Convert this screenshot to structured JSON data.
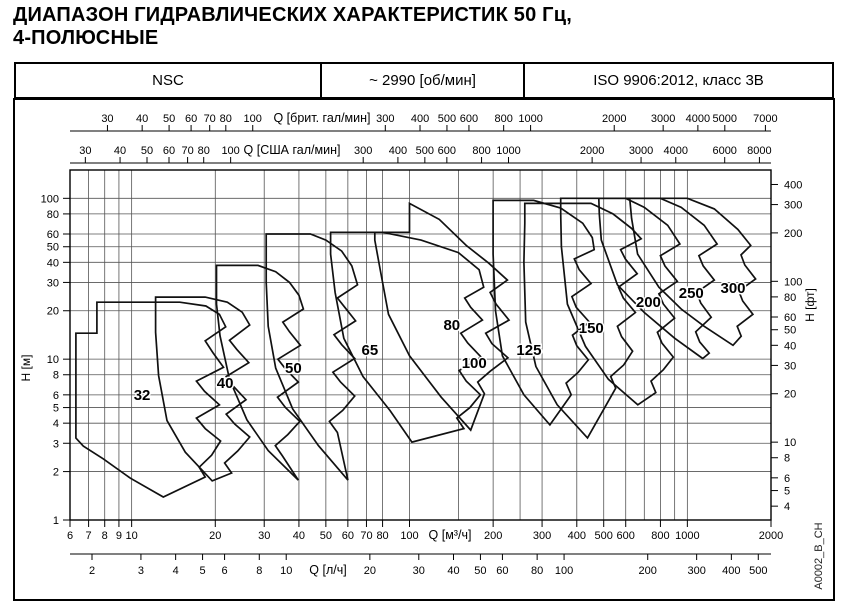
{
  "title": {
    "line1": "ДИАПАЗОН ГИДРАВЛИЧЕСКИХ ХАРАКТЕРИСТИК 50 Гц,",
    "line2": "4-ПОЛЮСНЫЕ"
  },
  "header": {
    "series": "NSC",
    "speed": "~ 2990 [об/мин]",
    "standard": "ISO 9906:2012, класс 3В"
  },
  "watermark": "A0002_B_CH",
  "colors": {
    "envelope_line": "#111111",
    "grid": "#555555",
    "border": "#000000",
    "background": "#ffffff"
  },
  "chart_data": {
    "type": "area",
    "subtype": "log-log pump range envelopes",
    "axes": {
      "x_main": {
        "label": "Q [м³/ч]",
        "scale": "log",
        "range": [
          6,
          2000
        ],
        "ticks": [
          6,
          7,
          8,
          9,
          10,
          20,
          30,
          40,
          50,
          60,
          70,
          80,
          100,
          200,
          300,
          400,
          500,
          600,
          800,
          1000,
          2000
        ],
        "gridlines": [
          6,
          7,
          8,
          9,
          10,
          20,
          30,
          40,
          50,
          60,
          70,
          80,
          100,
          150,
          200,
          250,
          300,
          400,
          500,
          600,
          700,
          800,
          900,
          1000,
          2000
        ]
      },
      "x_imp_gpm": {
        "label": "Q [брит. гал/мин]",
        "to_m3h": 0.27277,
        "ticks": [
          30,
          40,
          50,
          60,
          70,
          80,
          100,
          300,
          400,
          500,
          600,
          800,
          1000,
          2000,
          3000,
          4000,
          5000,
          7000
        ]
      },
      "x_us_gpm": {
        "label": "Q [США гал/мин]",
        "to_m3h": 0.22712,
        "ticks": [
          30,
          40,
          50,
          60,
          70,
          80,
          100,
          300,
          400,
          500,
          600,
          800,
          1000,
          2000,
          3000,
          4000,
          6000,
          8000
        ]
      },
      "x_ls": {
        "label": "Q [л/ч]",
        "to_m3h": 3.6,
        "ticks": [
          2,
          3,
          4,
          5,
          6,
          8,
          10,
          20,
          30,
          40,
          50,
          60,
          80,
          100,
          200,
          300,
          400,
          500
        ]
      },
      "y_main": {
        "label": "H [м]",
        "scale": "log",
        "range": [
          1,
          150
        ],
        "ticks": [
          1,
          2,
          3,
          4,
          5,
          6,
          8,
          10,
          20,
          30,
          40,
          50,
          60,
          80,
          100
        ],
        "gridlines": [
          1,
          2,
          3,
          4,
          5,
          6,
          8,
          10,
          20,
          30,
          40,
          50,
          60,
          80,
          100
        ]
      },
      "y_ft": {
        "label": "H [фт]",
        "to_m": 0.3048,
        "ticks": [
          4,
          5,
          6,
          8,
          10,
          20,
          30,
          40,
          50,
          60,
          80,
          100,
          200,
          300,
          400
        ]
      }
    },
    "envelopes": [
      {
        "label": "32",
        "label_at": [
          10.9,
          6.0
        ],
        "points": [
          [
            6.3,
            14.5
          ],
          [
            7.5,
            14.5
          ],
          [
            7.5,
            22.6
          ],
          [
            14.9,
            22.6
          ],
          [
            18.5,
            21.4
          ],
          [
            20.7,
            19
          ],
          [
            21.8,
            15.9
          ],
          [
            18.4,
            13
          ],
          [
            19.6,
            11
          ],
          [
            21.4,
            8.9
          ],
          [
            17.1,
            7.3
          ],
          [
            18.3,
            6.3
          ],
          [
            20.7,
            5.2
          ],
          [
            17.1,
            4.3
          ],
          [
            18.4,
            3.7
          ],
          [
            20.9,
            3.1
          ],
          [
            19.4,
            2.53
          ],
          [
            17.5,
            2.13
          ],
          [
            18.4,
            1.85
          ],
          [
            13,
            1.39
          ],
          [
            9.9,
            1.82
          ],
          [
            7.9,
            2.4
          ],
          [
            6.7,
            2.88
          ],
          [
            6.3,
            3.23
          ]
        ]
      },
      {
        "label": "40",
        "label_at": [
          21.7,
          7.1
        ],
        "points": [
          [
            12.2,
            24.3
          ],
          [
            18.4,
            24.3
          ],
          [
            22.1,
            22.6
          ],
          [
            25,
            19.6
          ],
          [
            26.6,
            16.3
          ],
          [
            22.5,
            13.1
          ],
          [
            23.9,
            11.5
          ],
          [
            26.4,
            9.5
          ],
          [
            21.9,
            7.8
          ],
          [
            23.2,
            6.8
          ],
          [
            25.8,
            5.6
          ],
          [
            21.9,
            4.55
          ],
          [
            23.5,
            3.95
          ],
          [
            26.6,
            3.28
          ],
          [
            24.1,
            2.69
          ],
          [
            21.6,
            2.26
          ],
          [
            22.9,
            1.96
          ],
          [
            19.5,
            1.75
          ],
          [
            15.6,
            2.64
          ],
          [
            13.4,
            4.15
          ],
          [
            12.5,
            7.9
          ],
          [
            12.2,
            14.7
          ]
        ]
      },
      {
        "label": "50",
        "label_at": [
          38.2,
          8.8
        ],
        "points": [
          [
            20.2,
            38.3
          ],
          [
            28.5,
            38.3
          ],
          [
            33,
            35
          ],
          [
            37,
            30
          ],
          [
            40,
            25
          ],
          [
            41.5,
            20.5
          ],
          [
            35,
            17
          ],
          [
            37,
            14.8
          ],
          [
            40.5,
            12.2
          ],
          [
            33.6,
            10
          ],
          [
            35.8,
            8.7
          ],
          [
            39.8,
            7.2
          ],
          [
            33.5,
            5.8
          ],
          [
            35.8,
            5
          ],
          [
            40.3,
            4.1
          ],
          [
            36.5,
            3.4
          ],
          [
            32.9,
            2.9
          ],
          [
            34.9,
            2.5
          ],
          [
            39.8,
            1.77
          ],
          [
            31,
            2.7
          ],
          [
            26,
            4.2
          ],
          [
            22.5,
            7.5
          ],
          [
            20.8,
            14
          ],
          [
            20.2,
            22
          ]
        ]
      },
      {
        "label": "65",
        "label_at": [
          72,
          11.4
        ],
        "points": [
          [
            30.5,
            60
          ],
          [
            44,
            60
          ],
          [
            50,
            55
          ],
          [
            57,
            47
          ],
          [
            62,
            38
          ],
          [
            65,
            29
          ],
          [
            55,
            24
          ],
          [
            58.5,
            21
          ],
          [
            64,
            17.3
          ],
          [
            53.5,
            14.2
          ],
          [
            57,
            12.3
          ],
          [
            63.5,
            10.1
          ],
          [
            53,
            8.3
          ],
          [
            56.5,
            7.2
          ],
          [
            63.5,
            5.9
          ],
          [
            57.5,
            4.8
          ],
          [
            51.5,
            4.1
          ],
          [
            55,
            3.5
          ],
          [
            60,
            1.77
          ],
          [
            47,
            2.9
          ],
          [
            38,
            4.9
          ],
          [
            33,
            8.8
          ],
          [
            31,
            16
          ],
          [
            30.5,
            30
          ]
        ]
      },
      {
        "label": "80",
        "label_at": [
          142,
          16.3
        ],
        "points": [
          [
            52,
            61.5
          ],
          [
            80,
            61.5
          ],
          [
            110,
            55
          ],
          [
            150,
            46
          ],
          [
            178,
            36
          ],
          [
            185,
            28
          ],
          [
            158,
            24
          ],
          [
            166,
            21
          ],
          [
            183,
            17.5
          ],
          [
            153,
            14.5
          ],
          [
            162,
            12.6
          ],
          [
            181,
            10.3
          ],
          [
            151,
            8.5
          ],
          [
            160,
            7.3
          ],
          [
            180,
            6
          ],
          [
            165,
            5
          ],
          [
            148,
            4.3
          ],
          [
            157,
            3.7
          ],
          [
            102,
            3.05
          ],
          [
            85,
            4.8
          ],
          [
            68,
            7.8
          ],
          [
            58,
            13.5
          ],
          [
            54,
            26
          ],
          [
            52,
            45
          ]
        ]
      },
      {
        "label": "100",
        "label_at": [
          171,
          9.45
        ],
        "points": [
          [
            75,
            61.5
          ],
          [
            100,
            61.5
          ],
          [
            100,
            93
          ],
          [
            128,
            74
          ],
          [
            160,
            51
          ],
          [
            193,
            39.5
          ],
          [
            225,
            31
          ],
          [
            195,
            26
          ],
          [
            205,
            22
          ],
          [
            228,
            17.5
          ],
          [
            188,
            14.5
          ],
          [
            198,
            12.5
          ],
          [
            226,
            10.2
          ],
          [
            195,
            8.4
          ],
          [
            176,
            7.2
          ],
          [
            186,
            6.1
          ],
          [
            166,
            3.62
          ],
          [
            130,
            5.8
          ],
          [
            100,
            10.5
          ],
          [
            84,
            19
          ],
          [
            78,
            38
          ],
          [
            75,
            55
          ]
        ]
      },
      {
        "label": "125",
        "label_at": [
          269,
          11.4
        ],
        "points": [
          [
            200,
            97
          ],
          [
            280,
            97
          ],
          [
            350,
            87
          ],
          [
            420,
            70
          ],
          [
            455,
            57
          ],
          [
            462,
            48
          ],
          [
            392,
            42
          ],
          [
            408,
            36
          ],
          [
            450,
            29.5
          ],
          [
            384,
            24.5
          ],
          [
            398,
            21
          ],
          [
            444,
            17
          ],
          [
            386,
            14.1
          ],
          [
            400,
            12.1
          ],
          [
            440,
            9.9
          ],
          [
            405,
            8.3
          ],
          [
            366,
            7.1
          ],
          [
            382,
            6
          ],
          [
            320,
            3.9
          ],
          [
            258,
            6
          ],
          [
            216,
            10.5
          ],
          [
            204,
            20
          ],
          [
            200,
            45
          ],
          [
            200,
            75
          ]
        ]
      },
      {
        "label": "150",
        "label_at": [
          451,
          15.6
        ],
        "points": [
          [
            260,
            93
          ],
          [
            450,
            93
          ],
          [
            540,
            80
          ],
          [
            630,
            65
          ],
          [
            682,
            56
          ],
          [
            575,
            48
          ],
          [
            598,
            42
          ],
          [
            660,
            34
          ],
          [
            565,
            28
          ],
          [
            588,
            24
          ],
          [
            650,
            19.5
          ],
          [
            560,
            16
          ],
          [
            580,
            13.8
          ],
          [
            635,
            11.2
          ],
          [
            590,
            9.2
          ],
          [
            530,
            7.8
          ],
          [
            552,
            6.6
          ],
          [
            437,
            3.24
          ],
          [
            340,
            5.2
          ],
          [
            285,
            9
          ],
          [
            262,
            17
          ],
          [
            258,
            40
          ],
          [
            260,
            70
          ]
        ]
      },
      {
        "label": "200",
        "label_at": [
          724,
          22.6
        ],
        "points": [
          [
            350,
            100
          ],
          [
            600,
            100
          ],
          [
            700,
            88
          ],
          [
            850,
            68
          ],
          [
            940,
            52
          ],
          [
            800,
            44
          ],
          [
            830,
            38
          ],
          [
            920,
            30.5
          ],
          [
            790,
            25.5
          ],
          [
            820,
            22
          ],
          [
            900,
            18
          ],
          [
            780,
            14.7
          ],
          [
            810,
            12.6
          ],
          [
            890,
            10.3
          ],
          [
            820,
            8.6
          ],
          [
            740,
            7.3
          ],
          [
            770,
            6.2
          ],
          [
            663,
            5.2
          ],
          [
            520,
            7.5
          ],
          [
            430,
            12
          ],
          [
            370,
            22
          ],
          [
            352,
            50
          ],
          [
            350,
            80
          ]
        ]
      },
      {
        "label": "250",
        "label_at": [
          1033,
          25.7
        ],
        "points": [
          [
            480,
            100
          ],
          [
            800,
            100
          ],
          [
            950,
            88
          ],
          [
            1150,
            68
          ],
          [
            1280,
            52
          ],
          [
            1100,
            44
          ],
          [
            1140,
            38
          ],
          [
            1250,
            31
          ],
          [
            1080,
            26
          ],
          [
            1118,
            22.3
          ],
          [
            1218,
            18.2
          ],
          [
            1072,
            14.8
          ],
          [
            1108,
            12.8
          ],
          [
            1198,
            10.9
          ],
          [
            1136,
            10.1
          ],
          [
            900,
            13.5
          ],
          [
            700,
            19.5
          ],
          [
            560,
            29
          ],
          [
            490,
            55
          ],
          [
            482,
            80
          ]
        ]
      },
      {
        "label": "300",
        "label_at": [
          1460,
          27.7
        ],
        "points": [
          [
            620,
            100
          ],
          [
            1000,
            100
          ],
          [
            1250,
            86
          ],
          [
            1520,
            64
          ],
          [
            1690,
            51
          ],
          [
            1560,
            44.5
          ],
          [
            1610,
            38.5
          ],
          [
            1760,
            31.5
          ],
          [
            1532,
            26.5
          ],
          [
            1582,
            23
          ],
          [
            1722,
            19
          ],
          [
            1512,
            16
          ],
          [
            1562,
            13.9
          ],
          [
            1460,
            12.2
          ],
          [
            1150,
            16
          ],
          [
            950,
            20.5
          ],
          [
            790,
            28
          ],
          [
            662,
            45
          ],
          [
            630,
            75
          ]
        ]
      }
    ]
  }
}
